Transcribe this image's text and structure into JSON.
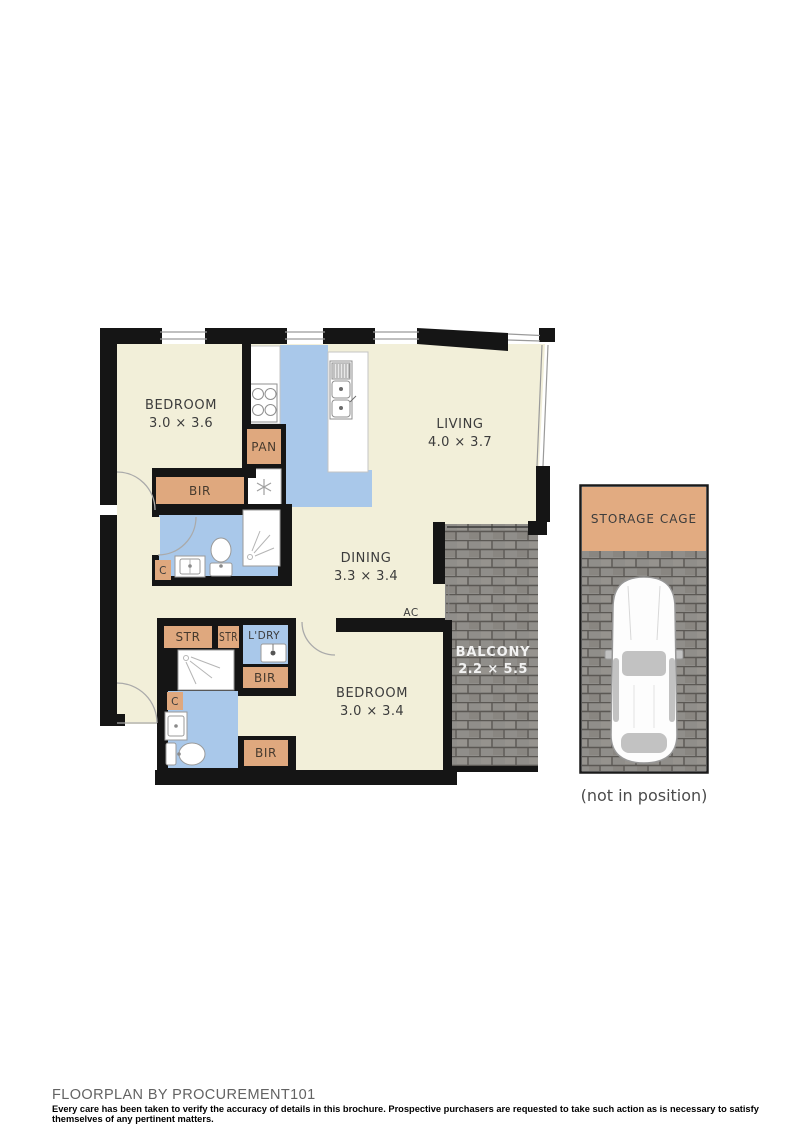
{
  "plan": {
    "bedroom1": {
      "label": "BEDROOM",
      "dims": "3.0 × 3.6"
    },
    "living": {
      "label": "LIVING",
      "dims": "4.0 × 3.7"
    },
    "dining": {
      "label": "DINING",
      "dims": "3.3 × 3.4"
    },
    "bedroom2": {
      "label": "BEDROOM",
      "dims": "3.0 × 3.4"
    },
    "balcony": {
      "label": "BALCONY",
      "dims": "2.2 × 5.5"
    },
    "labels": {
      "pantry": "PAN",
      "robe": "BIR",
      "storage_cupboard": "STR",
      "laundry": "L'DRY",
      "air_conditioner": "AC",
      "cupboard": "C"
    },
    "storage_cage": {
      "label": "STORAGE CAGE",
      "note": "(not in position)"
    }
  },
  "footer": {
    "title": "FLOORPLAN BY PROCUREMENT101",
    "disclaimer": "Every care has been taken to verify the accuracy of details in this brochure. Prospective purchasers are requested to take such action as is necessary to satisfy themselves of any pertinent matters."
  },
  "colors": {
    "floor": "#F2EFD9",
    "wet_area": "#A9C8EA",
    "joinery": "#DFA87E",
    "wall": "#151515",
    "brick": "#908E8A",
    "balcony_text": "#F2F2F2"
  }
}
